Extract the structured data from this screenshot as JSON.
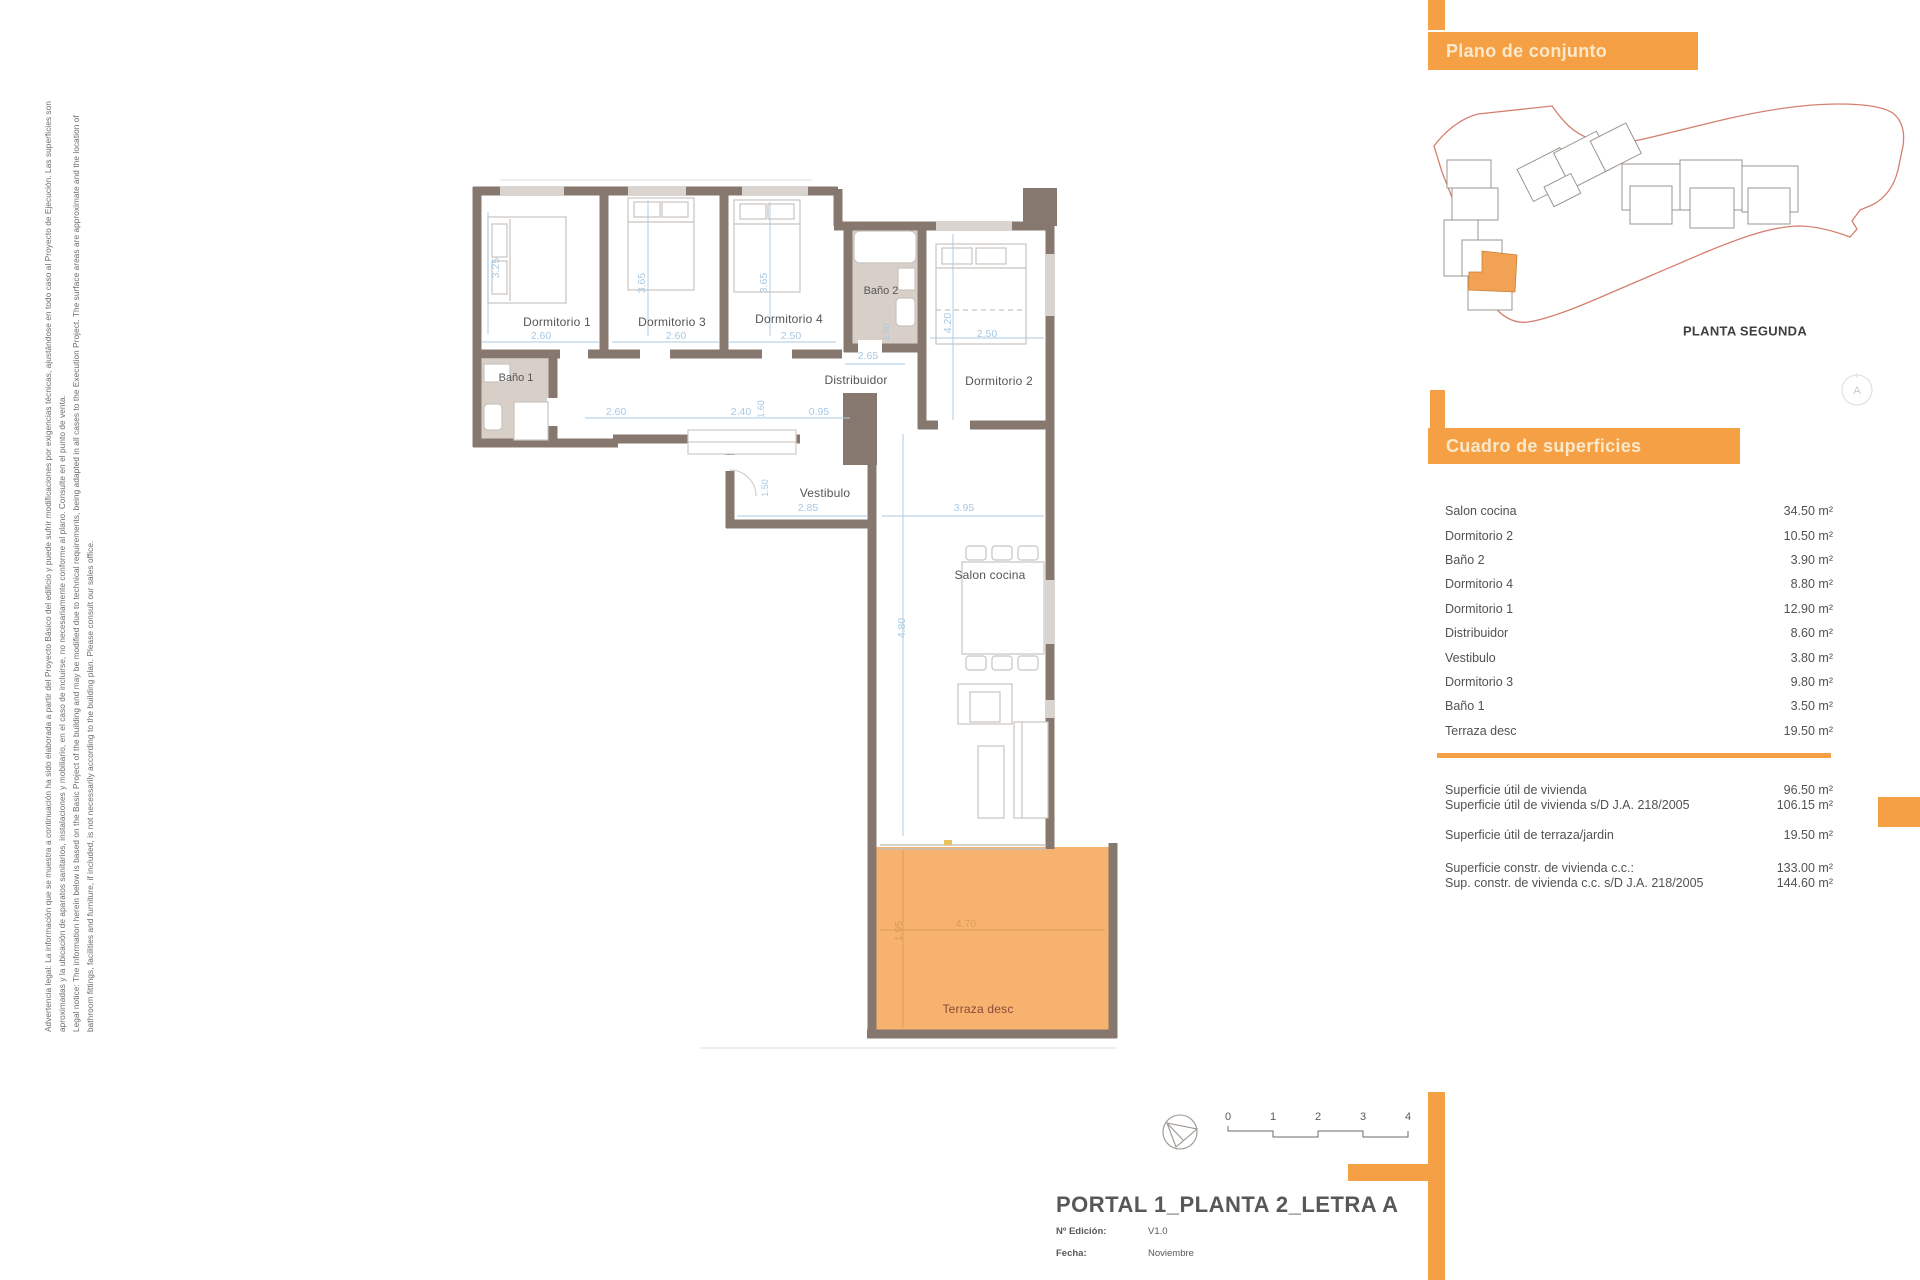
{
  "accent_color": "#f5a045",
  "terrace_color": "#f6b26e",
  "wall_color": "#87786f",
  "legal": {
    "lines": [
      "Advertencia legal: La información que se muestra a continuación ha sido elaborada a partir del Proyecto Básico del edificio y puede sufrir modificaciones por exigencias técnicas, ajustándose en todo caso al Proyecto de Ejecución. Las superficies son",
      "aproximadas y la ubicación de aparatos sanitarios, instalaciones y mobiliario, en el caso de incluirse, no necesariamente conforme al plano. Consulte en el punto de venta.",
      "Legal notice: The information herein below is based on the Basic Project of the building and may be modified due to technical requirements, being adapted in all cases to the Execution Project. The surface areas are approximate and the location of",
      "bathroom fittings, facilities and furniture, if included, is not necessarily according to the building plan. Please consult our sales office."
    ]
  },
  "floor_plan": {
    "rooms": {
      "dormitorio1": "Dormitorio 1",
      "dormitorio3": "Dormitorio 3",
      "dormitorio4": "Dormitorio 4",
      "dormitorio2": "Dormitorio 2",
      "bano1": "Baño 1",
      "bano2": "Baño 2",
      "distribuidor": "Distribuidor",
      "vestibulo": "Vestibulo",
      "salon": "Salon cocina",
      "terraza": "Terraza desc"
    },
    "dims": {
      "d1_h": "3.25",
      "d1_w": "2.60",
      "d3_h": "3.65",
      "d3_w": "2.60",
      "d4_h": "3.65",
      "d4_w": "2.50",
      "d2_h": "4.20",
      "d2_w": "2.50",
      "bano2_w": "1.60",
      "distribuidor_w": "2.65",
      "pass_1": "2.60",
      "pass_2": "2.40",
      "pass_3": "0.95",
      "pass_v": "1.60",
      "vest_w": "2.85",
      "vest_v": "1.50",
      "salon_w": "3.95",
      "salon_h": "4.80",
      "terraza_w": "4.70",
      "terraza_h": "1.95"
    }
  },
  "site_panel": {
    "header": "Plano de conjunto",
    "caption": "PLANTA SEGUNDA",
    "compass_letter": "A"
  },
  "surfaces_panel": {
    "header": "Cuadro de superficies",
    "rows": [
      {
        "label": "Salon cocina",
        "value": "34.50 m²"
      },
      {
        "label": "Dormitorio 2",
        "value": "10.50 m²"
      },
      {
        "label": "Baño 2",
        "value": "3.90 m²"
      },
      {
        "label": "Dormitorio 4",
        "value": "8.80 m²"
      },
      {
        "label": "Dormitorio 1",
        "value": "12.90 m²"
      },
      {
        "label": "Distribuidor",
        "value": "8.60 m²"
      },
      {
        "label": "Vestibulo",
        "value": "3.80 m²"
      },
      {
        "label": "Dormitorio 3",
        "value": "9.80 m²"
      },
      {
        "label": "Baño 1",
        "value": "3.50 m²"
      },
      {
        "label": "Terraza desc",
        "value": "19.50 m²"
      }
    ],
    "summary": [
      {
        "label": "Superficie útil de vivienda",
        "value": "96.50 m²"
      },
      {
        "label": "Superficie útil de vivienda s/D J.A. 218/2005",
        "value": "106.15 m²"
      },
      {
        "label": "Superficie útil de terraza/jardin",
        "value": "19.50 m²"
      },
      {
        "label": "Superficie constr. de vivienda c.c.:",
        "value": "133.00 m²"
      },
      {
        "label": "Sup. constr. de vivienda c.c. s/D J.A. 218/2005",
        "value": "144.60 m²"
      }
    ]
  },
  "scale_bar": {
    "ticks": [
      "0",
      "1",
      "2",
      "3",
      "4"
    ]
  },
  "title_block": {
    "title": "PORTAL 1_PLANTA 2_LETRA A",
    "edition_label": "Nº Edición:",
    "edition_value": "V1.0",
    "date_label": "Fecha:",
    "date_value": "Noviembre"
  }
}
